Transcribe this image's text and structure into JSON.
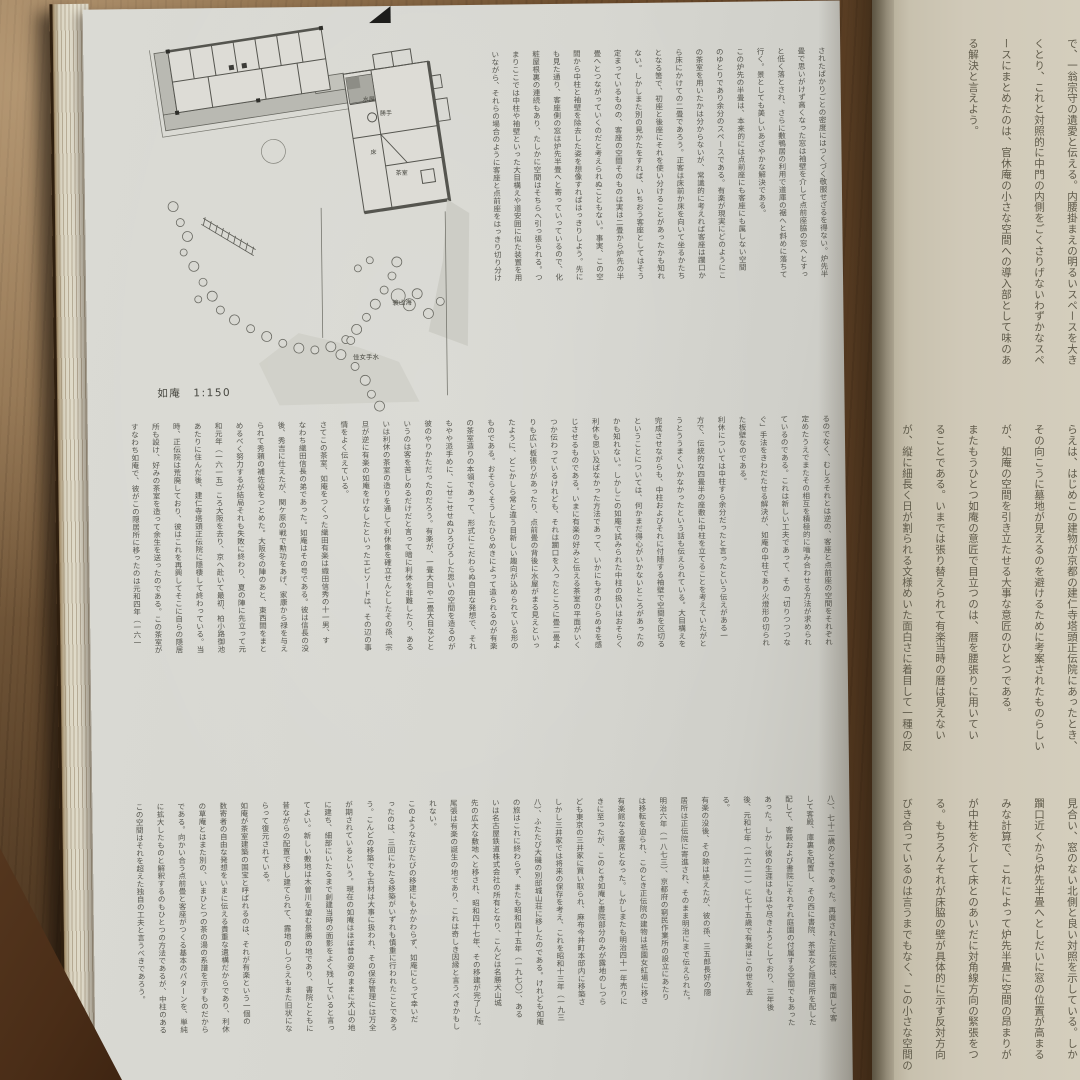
{
  "book": {
    "left_page": {
      "figure": {
        "caption": "如庵　1:150",
        "room_labels": [
          "水屋",
          "勝手",
          "床",
          "茶室"
        ],
        "garden_labels": [
          "簑山海",
          "佳女手水"
        ]
      },
      "upper_columns": [
        "されたばかりごとの密度にはつくづく敬服せざるを得ない。炉先半",
        "畳で思いがけず高くなった窓は袖壁を介して点前座脇の窓へとすっ",
        "と低く落とされ、さらに敷鴨居の利用で道庫の裾へと斜めに落ちて",
        "行く。景としても美しいあざやかな解決である。",
        "  この炉先の半畳は、本来的には点前座にも客座にも属しない空間",
        "のゆとりであり余分のスペースである。有楽が現実にどのようにこ",
        "の茶室を用いたかは分からないが、常識的に考えれば客座は躙口か",
        "ら床にかけての二畳であろう。正客は床前か床を向いて坐るかたち",
        "となる筈で、初座と後座にそれを使い分けることがあったかも知れ",
        "ない。しかしまた別の見かたをすれば、いちおう客座としてはそう",
        "定まっているものの、客座の空間そのものは実は二畳から炉先の半",
        "畳へとつながっていくのだと考えられぬこともない。事実、この空",
        "間から中柱と袖壁を除去した姿を想像すればはっきりしよう。先に",
        "も見た通り、客座側の窓は炉先半畳へと寄っていっているので、化",
        "粧屋根裏の連続もあり、たしかに空間はそちらへ引っ張られる。つ",
        "まりここでは中柱や袖壁といった大目構えや道安囲に似た装置を用",
        "いながら、それらの場合のように客座と点前座をはっきり切り分け"
      ],
      "middle_columns": [
        "るのでなく、むしろそれとは逆の、客座と点前座の空間をそれぞれ",
        "定めたうえでまたその相互を積極的に嚙み合わせる方法が求められ",
        "ているのである。これは新しい工夫であって、その「切りつつつな",
        "ぐ」手法をきわだたせる解決が、如庵の中柱であり火燈形の切られ",
        "た板壁なのである。",
        "  利休については中柱すら余分だったと言ったという伝えがある一",
        "方で、伝統的な四畳半の座敷に中柱を立てることを考えていたがと",
        "うとううまくいかなかったという話も伝えられている。大目構えを",
        "完成させながらも、中柱およびそれに付随する袖壁で空間を区切る",
        "ということについては、何かまだ得心がいかないところがあったの",
        "かも知れない。しかしこの如庵で試みられた中柱の扱いはおそらく",
        "利休も思い及ばなかった方法であって、いかにも才のひらめきを感",
        "じさせるものである。いまに有楽の好みと伝える茶室の平面がいく",
        "つか伝わっているけれども、それは躙口を入ったところに畳二畳よ",
        "りも広い板張りがあったり、点前畳の背後に水屋がまる見えといっ",
        "たように、どこかしら常と違う目新しい趣向が込められている形の",
        "ものである。おそらくそうしたひらめきによって造られるのが有楽",
        "の茶室造りの本領であって、形式にこだわらぬ自由な発想で、それ",
        "もやや派手めに、こせこせせぬひろびろした思いの空間を造るのが",
        "彼のやりかただったのだろう。有楽が、一畳大目や二畳大目などと",
        "いうのは客を苦しめるだけだと言って暗に利休を非難したり、ある",
        "いは利休の茶室の造りを通して利休像を確立せんとしたその孫、宗",
        "旦が逆に有楽の如庵をけなしたといったエピソードは、その辺の事",
        "情をよく伝えている。",
        "  さてこの茶室、如庵をつくった織田有楽は織田信秀の十一男、す",
        "なわち織田信長の弟であった。如庵はその号である。彼は信長の没",
        "後、秀吉に仕えたが、関ケ原の戦で勲功をあげ、家康から禄を与え",
        "られて秀頼の補佐役をつとめた。大阪冬の陣のあと、東西間をまと",
        "めるべく努力するが結局それも失敗に終わり、夏の陣に先立って元",
        "和元年（一六一五）ころ大阪を去り、京へ赴いて最初、柏小路御池",
        "あたりに住んだ後、建仁寺塔頭正伝院に隠棲して終わっている。当",
        "時、正伝院は荒廃しており、彼はこれを再興してそこに自らの隠居",
        "所も設け、好みの茶室を造って余生を送ったのである。この茶室が",
        "すなわち如庵で、彼がこの隠居所に移ったのは元和四年（一六一"
      ],
      "lower_columns": [
        "八）、七十二歳のときであった。再興された正伝院は、南面して客",
        "して客殿、庫裏を配置し、その西に書院、茶室など隠居所を配した",
        "配して、客殿および書院にそれぞれ庭園の付属する空間でもあった",
        "あった。しかし彼の生涯はもはや尽きようとしており、三年後",
        "後、元和七年（一六二一）に七十五歳で有楽はこの世を去",
        "る。",
        "  有楽の没後、その跡は絶えたが、彼の孫、三五郎長好の隠",
        "居所は正伝院に寄進され、そのまま明治にまで伝えられた。",
        "明治六年（一八七三）、京都府の窮民作業所の設立にあたり",
        "は移転を迫られ、このとき正伝院の建物は祇園女紅場に移さ",
        "有楽館なる宴席となった。しかしまたも明治四十一年売りに",
        "きに至ったが、このとき如庵と書院部分のみが露地のしつら",
        "ども東京の三井家に買い取られ、麻布今井町本邸内に移築さ",
        "しかし三井家では将来の保存を考え、これを昭和十三年（一九三",
        "八）、ふたたび大磯の別邸城山荘に移したのである。けれども如庵",
        "の旅はこれに終わらず、またも昭和四十五年（一九七〇）、ある",
        "いは名古屋鉄道株式会社の所有となり、こんどは名勝犬山城",
        "先の広大な敷地へと移され、昭和四十七年、その移建が完了した。",
        "尾張は有楽の誕生の地であり、これは奇しき因縁と言うべきかもし",
        "れない。",
        "  このようなたびたびの移建にもかかわらず、如庵にとって幸いだ",
        "ったのは、三回にわたる移築がいずれも慎重に行われたことであろ",
        "う。こんどの移築でも古材は大事に扱われ、その保存管理には万全",
        "が期されているという。現在の如庵はほぼ昔の姿のままに犬山の地",
        "に建ち、細部にいたるまで創建当時の面影をよく残していると言っ",
        "てよい。新しい敷地は木曽川を望む景勝の地であり、書院とともに",
        "昔ながらの配置で移し建てられて、露地のしつらえもまた旧状にな",
        "らって復元されている。",
        "  如庵が茶室建築の国宝と呼ばれるのは、それが有楽という一個の",
        "数寄者の自由な発想をいまに伝える貴重な遺構だからであり、利休",
        "の草庵とはまた別の、いまひとつの茶の湯の系譜を示すものだから",
        "である。向かい合う点前畳と客座がつくる基本のパターンを、単純",
        "に拡大したものと解釈するのもひとつの方法であるが、中柱のある",
        "この空間はそれを超えた独自の工夫と言うべきであろう。"
      ]
    },
    "right_page": {
      "upper_columns": [
        "で、一翁宗守の遺愛と伝える。内腰掛まえの明るいスペースを大き",
        "くとり、これと対照的に中門の内側をごくさりげないわずかなスペ",
        "ースにまとめたのは、官休庵の小さな空間への導入部として味のあ",
        "る解決と言えよう。"
      ],
      "middle_columns": [
        "らえは、はじめこの建物が京都の建仁寺塔頭正伝院にあったとき、",
        "その向こうに墓地が見えるのを避けるために考案されたものらしい",
        "が、如庵の空間を引き立たせる大事な意匠のひとつである。",
        "  またもうひとつ如庵の意匠で目立つのは、暦を腰張りに用いてい",
        "ることである。いまでは張り替えられて有楽当時の暦は見えない",
        "が、縦に細長く日が割られる文様めいた面白さに着目して一種の反"
      ],
      "lower_columns": [
        "見合い、窓のない北側と良い対照を示している。しか",
        "躙口近くから炉先半畳へとしだいに窓の位置が高まる",
        "みな計算で、これによって炉先半畳に空間の昂まりが",
        "が中柱を介して床とのあいだに対角線方向の緊張をつ",
        "る。もちろんそれが床脇の壁が具体的に示す反対方向",
        "びき合っているのは言うまでもなく、この小さな空間の"
      ]
    }
  }
}
